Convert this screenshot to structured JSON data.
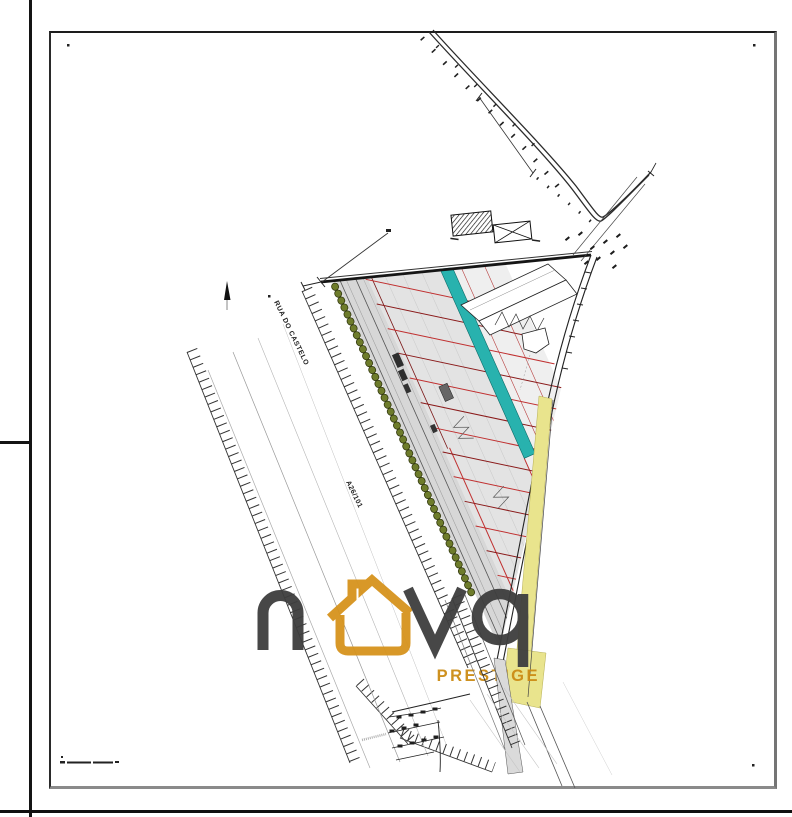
{
  "plan": {
    "street_label": "RUA DO CASTELO",
    "parcel_ref_label": "A26/101"
  },
  "watermark": {
    "logo_text": "nova",
    "tagline": "PRESTIGE",
    "color_dark": "#3e3e3e",
    "color_gold": "#d3921c"
  },
  "legend_colors": {
    "teal_strip": "#28b2ae",
    "yellow_strip": "#e9e48d",
    "lot_divider_red": "#c03030",
    "lot_divider_maroon": "#8a1a1a",
    "tree_green": "#6e7c2b",
    "parcel_gray": "#e3e3e3"
  }
}
